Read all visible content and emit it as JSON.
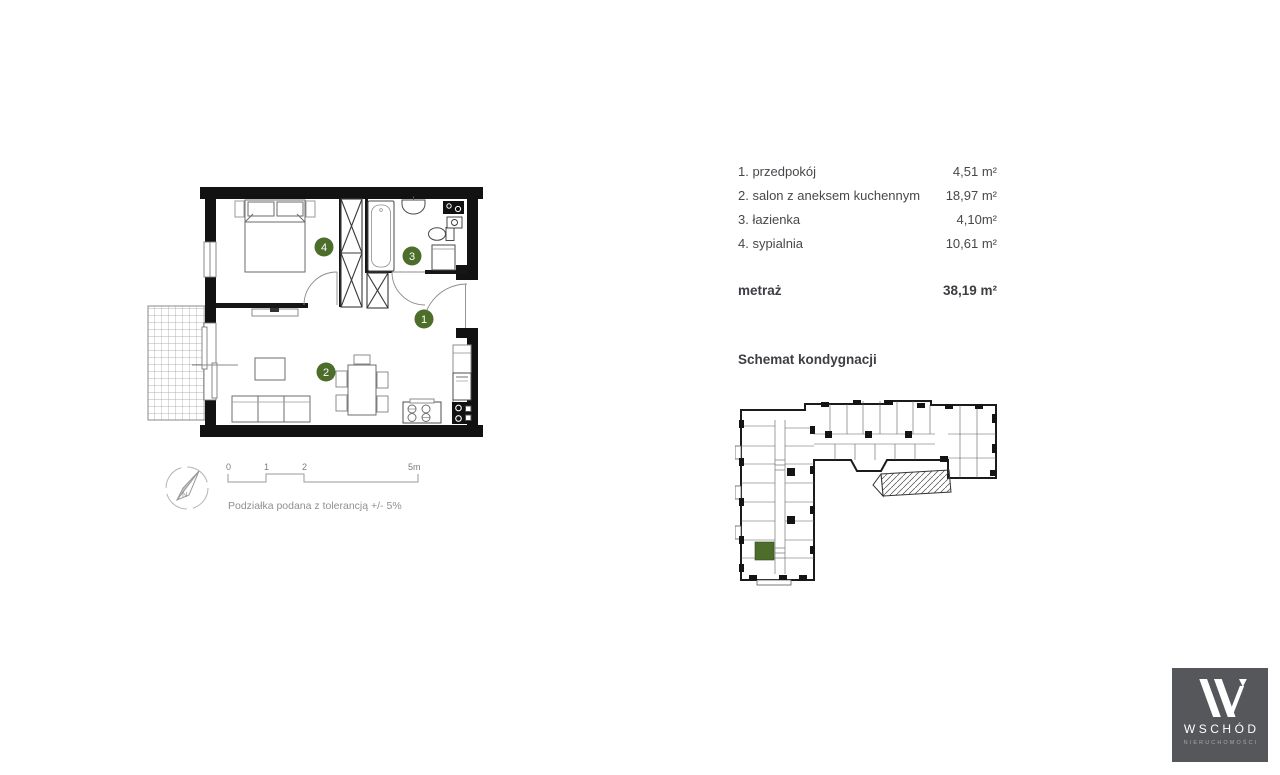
{
  "legend": {
    "rooms": [
      {
        "id": "1",
        "label": "1. przedpokój",
        "area": "4,51 m²"
      },
      {
        "id": "2",
        "label": "2. salon z aneksem kuchennym",
        "area": "18,97 m²"
      },
      {
        "id": "3",
        "label": "3. łazienka",
        "area": "4,10m²"
      },
      {
        "id": "4",
        "label": "4. sypialnia",
        "area": "10,61 m²"
      }
    ],
    "total_label": "metraż",
    "total_area": "38,19 m²"
  },
  "schematic": {
    "title": "Schemat kondygnacji",
    "highlight_color": "#4d6e2a"
  },
  "floor_plan": {
    "marker_color": "#4d6e2a",
    "scale_bar": {
      "t0": "0",
      "t1": "1",
      "t2": "2",
      "t3": "5m"
    },
    "tolerance_note": "Podziałka podana z tolerancją +/- 5%",
    "compass_label": "N"
  },
  "logo": {
    "brand": "WSCHÓD",
    "subtitle": "NIERUCHOMOŚCI",
    "bg": "#56575b"
  }
}
